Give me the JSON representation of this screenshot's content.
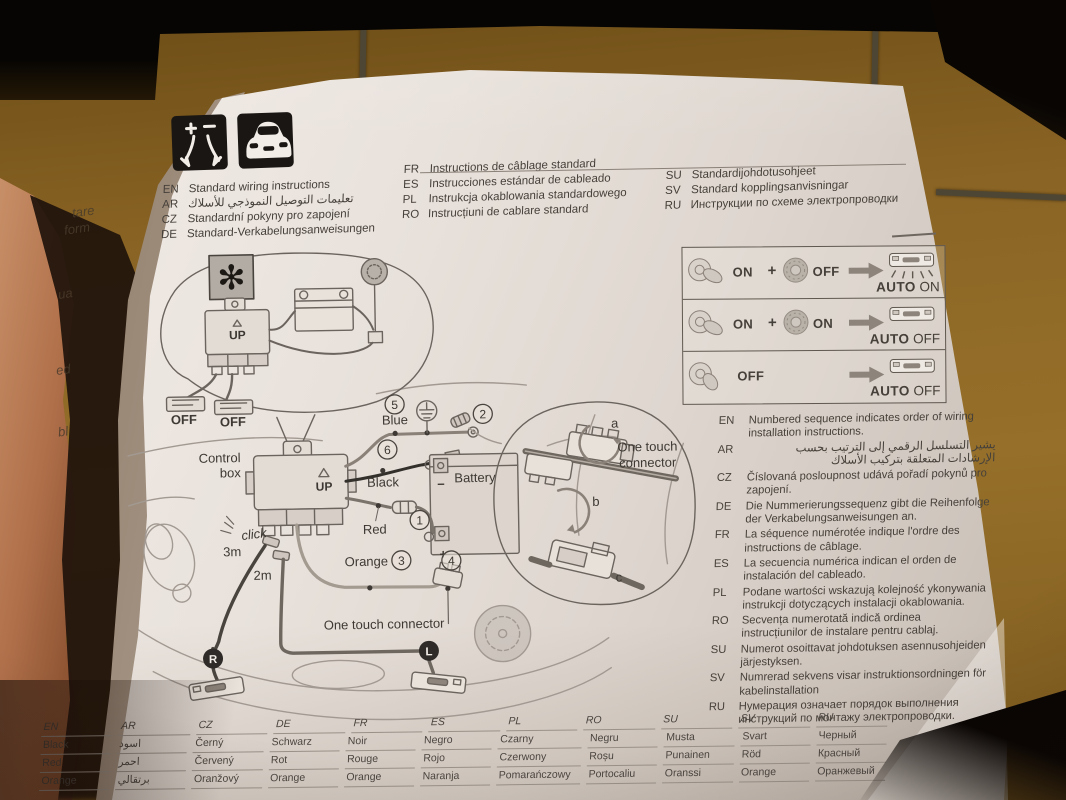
{
  "title_langs": {
    "group1": [
      {
        "code": "EN",
        "text": "Standard wiring instructions"
      },
      {
        "code": "AR",
        "text": "تعليمات التوصيل النموذجي للأسلاك"
      },
      {
        "code": "CZ",
        "text": "Standardní pokyny pro zapojení"
      },
      {
        "code": "DE",
        "text": "Standard-Verkabelungsanweisungen"
      }
    ],
    "group2": [
      {
        "code": "FR",
        "text": "Instructions de câblage standard"
      },
      {
        "code": "ES",
        "text": "Instrucciones estándar de cableado"
      },
      {
        "code": "PL",
        "text": "Instrukcja okablowania standardowego"
      },
      {
        "code": "RO",
        "text": "Instrucțiuni de cablare standard"
      }
    ],
    "group3": [
      {
        "code": "SU",
        "text": "Standardijohdotusohjeet"
      },
      {
        "code": "SV",
        "text": "Standard kopplingsanvisningar"
      },
      {
        "code": "RU",
        "text": "Инструкции по схеме электропроводки"
      }
    ]
  },
  "auto_box": {
    "rows": [
      {
        "key_state": "ON",
        "plus": "+",
        "switch_state": "OFF",
        "result_prefix": "AUTO",
        "result_state": "ON"
      },
      {
        "key_state": "ON",
        "plus": "+",
        "switch_state": "ON",
        "result_prefix": "AUTO",
        "result_state": "OFF"
      },
      {
        "key_state": "OFF",
        "result_prefix": "AUTO",
        "result_state": "OFF"
      }
    ]
  },
  "diagram": {
    "inset_top": {
      "up": "UP",
      "off_left": "OFF",
      "off_right": "OFF"
    },
    "labels": {
      "control_box_l1": "Control",
      "control_box_l2": "box",
      "up": "UP",
      "blue": "Blue",
      "black": "Black",
      "red": "Red",
      "orange": "Orange",
      "battery": "Battery",
      "battery_minus": "−",
      "battery_plus": "+",
      "one_touch": "One touch connector",
      "click": "click",
      "len_3m": "3m",
      "len_2m": "2m"
    },
    "numbers": [
      "1",
      "2",
      "3",
      "4",
      "5",
      "6"
    ],
    "badges": {
      "r": "R",
      "l": "L"
    },
    "inset_right": {
      "l1": "One touch",
      "l2": "connector",
      "steps": [
        "a",
        "b",
        "c"
      ]
    }
  },
  "sequence_notes": [
    {
      "code": "EN",
      "text": "Numbered sequence indicates order of wiring installation instructions."
    },
    {
      "code": "AR",
      "text": "يشير التسلسل الرقمي إلى الترتيب بحسب الإرشادات المتعلقة بتركيب الأسلاك"
    },
    {
      "code": "CZ",
      "text": "Číslovaná posloupnost udává pořadí pokynů pro zapojení."
    },
    {
      "code": "DE",
      "text": "Die Nummerierungssequenz gibt die Reihenfolge der Verkabelungsanweisungen an."
    },
    {
      "code": "FR",
      "text": "La séquence numérotée indique l'ordre des instructions de câblage."
    },
    {
      "code": "ES",
      "text": "La secuencia numérica indican el orden de instalación del cableado."
    },
    {
      "code": "PL",
      "text": "Podane wartości wskazują kolejność ykonywania instrukcji dotyczących instalacji okablowania."
    },
    {
      "code": "RO",
      "text": "Secvența numerotată indică ordinea instrucțiunilor de instalare pentru cablaj."
    },
    {
      "code": "SU",
      "text": "Numerot osoittavat johdotuksen asennusohjeiden järjestyksen."
    },
    {
      "code": "SV",
      "text": "Numrerad sekvens visar instruktionsordningen för kabelinstallation"
    },
    {
      "code": "RU",
      "text": "Нумерация означает порядок выполнения инструкций по монтажу электропроводки."
    }
  ],
  "color_table": {
    "headers": [
      "EN",
      "AR",
      "CZ",
      "DE",
      "FR",
      "ES",
      "PL",
      "RO",
      "SU",
      "SV",
      "RU"
    ],
    "rows": [
      [
        "Black",
        "اسود",
        "Černý",
        "Schwarz",
        "Noir",
        "Negro",
        "Czarny",
        "Negru",
        "Musta",
        "Svart",
        "Черный"
      ],
      [
        "Red",
        "احمر",
        "Červený",
        "Rot",
        "Rouge",
        "Rojo",
        "Czerwony",
        "Roșu",
        "Punainen",
        "Röd",
        "Красный"
      ],
      [
        "Orange",
        "برتقالي",
        "Oranžový",
        "Orange",
        "Orange",
        "Naranja",
        "Pomarańczowy",
        "Portocaliu",
        "Oranssi",
        "Orange",
        "Оранжевый"
      ]
    ]
  },
  "underpage_fragments": [
    "tare",
    "form",
    "ua",
    "ed",
    "bl"
  ],
  "colors": {
    "paper": "#e9e2dc",
    "ink": "#46403a",
    "sketch": "#6b645e",
    "tile": "#8a6424",
    "thumb": "#b0704a"
  }
}
